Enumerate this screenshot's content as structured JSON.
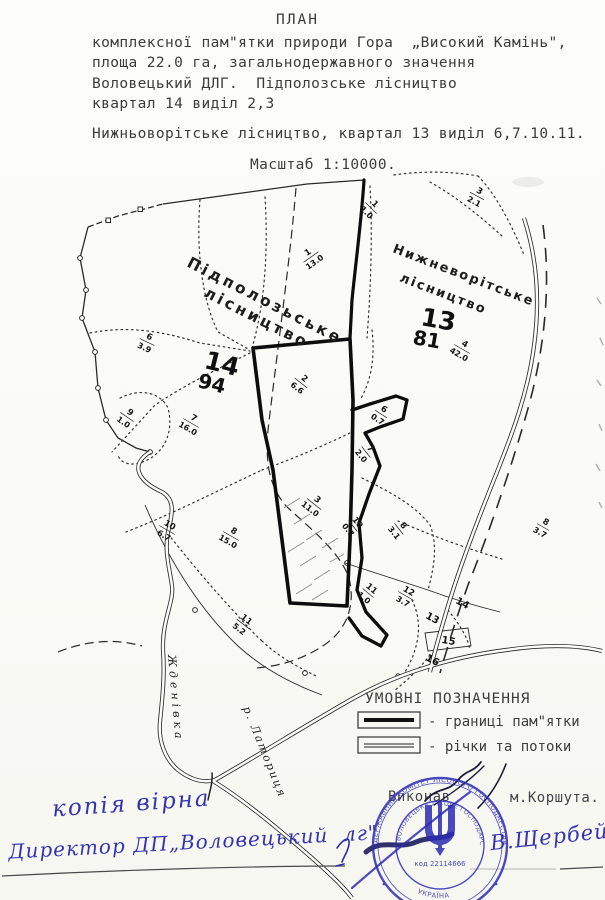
{
  "document": {
    "title": "ПЛАН",
    "subtitle_lines": [
      "комплексної пам\"ятки природи Гора  „Високий Камінь\",",
      "площа 22.0 га, загальнодержавного значення",
      "Воловецький ДЛГ.  Підполозське лісництво",
      "квартал 14 виділ 2,3"
    ],
    "line_district2": "Нижньоворітське лісництво, квартал 13 виділ 6,7.10.11.",
    "scale": "Масштаб 1:10000."
  },
  "map": {
    "district_left_line1": "Підполозьське",
    "district_left_line2": "лісництво",
    "district_right_line1": "Нижневорітське",
    "district_right_line2": "лісництво",
    "quarter_left_num": "14",
    "quarter_left_sub": "94",
    "quarter_right_num": "13",
    "quarter_right_sub": "81",
    "parcels": [
      {
        "num": "1",
        "area": "1.0"
      },
      {
        "num": "1",
        "area": "13.0"
      },
      {
        "num": "6",
        "area": "3.9"
      },
      {
        "num": "9",
        "area": "1.0"
      },
      {
        "num": "7",
        "area": "16.0"
      },
      {
        "num": "2",
        "area": "6.6"
      },
      {
        "num": "10",
        "area": "6.7"
      },
      {
        "num": "8",
        "area": "15.0"
      },
      {
        "num": "3",
        "area": "11.0"
      },
      {
        "num": "11",
        "area": "5.2"
      },
      {
        "num": "3",
        "area": "2.1"
      },
      {
        "num": "4",
        "area": "42.0"
      },
      {
        "num": "6",
        "area": "0.7"
      },
      {
        "num": "7",
        "area": "2.0"
      },
      {
        "num": "10",
        "area": "0.7"
      },
      {
        "num": "8",
        "area": "3.1"
      },
      {
        "num": "12",
        "area": "3.7"
      },
      {
        "num": "11",
        "area": "1.0"
      },
      {
        "num": "8",
        "area": "3.7"
      }
    ],
    "plain_labels": [
      "14",
      "13",
      "15",
      "16"
    ],
    "rivers": {
      "left": "Жденівка",
      "bottom": "р. Латориця"
    }
  },
  "legend": {
    "title": "УМОВНІ ПОЗНАЧЕННЯ",
    "items": [
      {
        "label": "- границі пам\"ятки"
      },
      {
        "label": "- річки та потоки"
      }
    ]
  },
  "footer": {
    "executed_label": "Виконав",
    "executor": "м.Коршута.",
    "copy_note": "копія вірна",
    "director_line": "Директор ДП„Воловецький  лг\"",
    "signature": "В.Щербей"
  },
  "stamp": {
    "ring_top": "ДЕРЖАВНИЙ КОМІТЕТ ЛІСОВОГО ГОСПОДАРСТВА УКРАЇНИ",
    "ring_inner": "ВОЛОВЕЦЬКЕ ЛІСОВЕ ГОСПОДАРСТВО",
    "code": "код 22114666",
    "country": "УКРАЇНА",
    "color": "#2d2bb5"
  },
  "colors": {
    "typed_ink": "#3c3c3c",
    "map_ink": "#222222",
    "pen_blue": "#3434b2"
  }
}
